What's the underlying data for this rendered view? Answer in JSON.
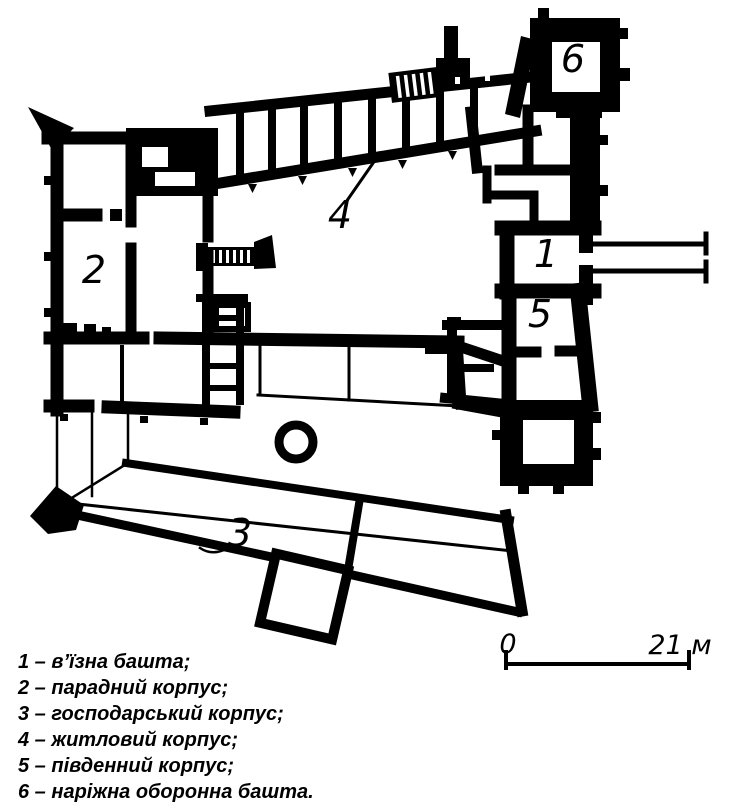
{
  "plan_labels": {
    "l1": "1",
    "l2": "2",
    "l3": "3",
    "l4": "4",
    "l5": "5",
    "l6": "6"
  },
  "scale_bar": {
    "zero": "0",
    "length": "21 м"
  },
  "legend": {
    "items": [
      {
        "line": "1 – в’їзна башта;"
      },
      {
        "line": "2 – парадний корпус;"
      },
      {
        "line": "3 – господарський корпус;"
      },
      {
        "line": "4 – житловий корпус;"
      },
      {
        "line": "5 – південний корпус;"
      },
      {
        "line": "6 – наріжна оборонна башта."
      }
    ]
  },
  "colors": {
    "ink": "#000000",
    "paper": "#ffffff"
  }
}
